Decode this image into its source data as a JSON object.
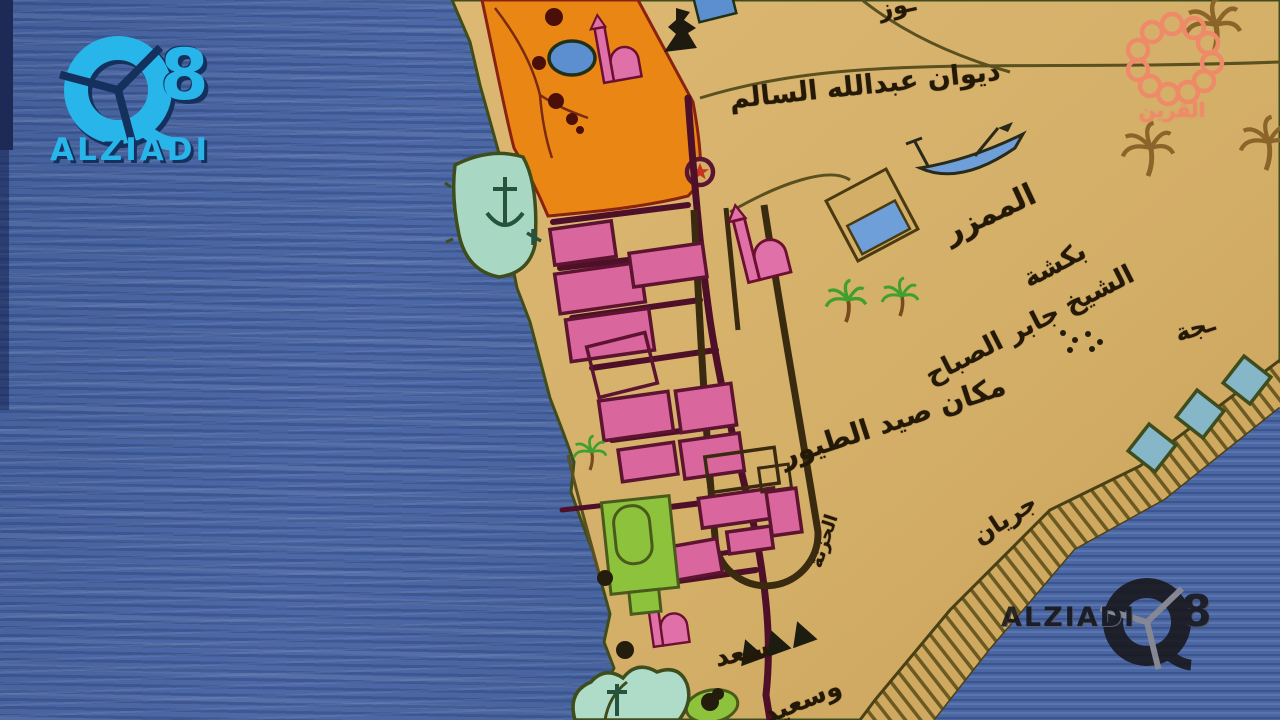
{
  "branding": {
    "top_left_logo": {
      "number": "8",
      "name": "ALZIADI",
      "color": "#28b5e9"
    },
    "top_right_logo": {
      "name_ar": "القرين",
      "color": "#ef8a68"
    },
    "watermark": {
      "name": "ALZIADI",
      "number": "8"
    }
  },
  "map": {
    "labels": {
      "diwan": "ديوان عبدالله السالم",
      "mamzar": "الممزر",
      "baksha": "بكشة",
      "sheikh_jaber": "الشيخ جابر الصباح",
      "bird_hunting": "مكان صيد الطيور",
      "jiryan": "جريان",
      "hazna": "الحزنة",
      "saad": "سعد",
      "wasaeed": "وسعيد",
      "partial_right": "ـجة",
      "partial_top": "ـوز"
    },
    "colors": {
      "sea": "#4a66a2",
      "land": "#d3ae67",
      "district_orange": "#ea8714",
      "buildings_pink": "#d9669c",
      "outline_maroon": "#5c1430",
      "harbor_teal": "#a8d8c4",
      "garden_green": "#8cc23c",
      "water_icon_blue": "#6f9fd8",
      "coast_olive": "#3f4d1c",
      "label_ink": "#241806"
    }
  }
}
